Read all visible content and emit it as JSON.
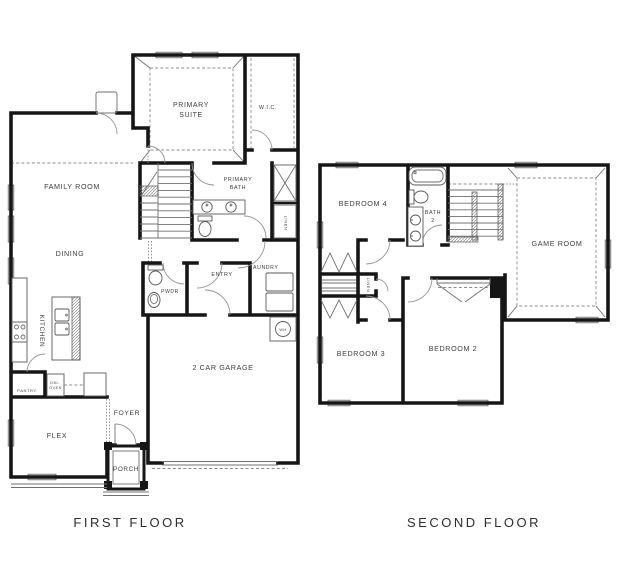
{
  "colors": {
    "background": "#ffffff",
    "wall": "#161616",
    "thin_line": "#707070",
    "window_fill": "#dcdcdc",
    "text": "#3f3f3f"
  },
  "first_floor": {
    "caption": "FIRST FLOOR",
    "labels": {
      "family_room": "FAMILY ROOM",
      "dining": "DINING",
      "kitchen": "KITCHEN",
      "pantry": "PANTRY",
      "dbl_oven_line1": "DBL.",
      "dbl_oven_line2": "OVEN",
      "flex": "FLEX",
      "foyer": "FOYER",
      "porch": "PORCH",
      "garage": "2 CAR GARAGE",
      "primary_suite_line1": "PRIMARY",
      "primary_suite_line2": "SUITE",
      "wic": "W.I.C.",
      "primary_bath_line1": "PRIMARY",
      "primary_bath_line2": "BATH",
      "powder": "PWDR",
      "entry": "ENTRY",
      "laundry": "LAUNDRY",
      "linen": "LINEN",
      "water_heater": "WH"
    }
  },
  "second_floor": {
    "caption": "SECOND FLOOR",
    "labels": {
      "bedroom4": "BEDROOM 4",
      "bath2_line1": "BATH",
      "bath2_line2": "2",
      "game_room": "GAME ROOM",
      "bedroom3": "BEDROOM 3",
      "bedroom2": "BEDROOM 2",
      "linen": "LINEN"
    }
  }
}
